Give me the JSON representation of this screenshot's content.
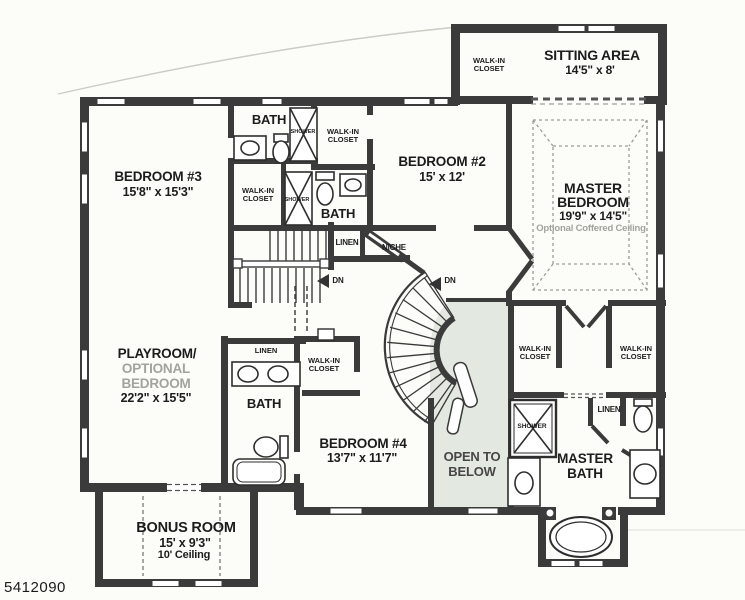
{
  "plan_number": "5412090",
  "colors": {
    "wall": "#3b3b3b",
    "open_below_fill": "#e3e8e0",
    "muted_text": "#a2a29e"
  },
  "rooms": {
    "bedroom3": {
      "name": "BEDROOM #3",
      "dims": "15'8\" x 15'3\""
    },
    "bedroom2": {
      "name": "BEDROOM #2",
      "dims": "15' x 12'"
    },
    "bedroom4": {
      "name": "BEDROOM #4",
      "dims": "13'7\" x 11'7\""
    },
    "sitting_area": {
      "name": "SITTING AREA",
      "dims": "14'5\" x 8'"
    },
    "master_bedroom": {
      "name1": "MASTER",
      "name2": "BEDROOM",
      "dims": "19'9\" x 14'5\"",
      "note": "Optional Coffered Ceiling"
    },
    "playroom": {
      "name1": "PLAYROOM/",
      "name2": "OPTIONAL",
      "name3": "BEDROOM",
      "dims": "22'2\" x 15'5\""
    },
    "bonus_room": {
      "name": "BONUS ROOM",
      "dims": "15' x 9'3\"",
      "note": "10' Ceiling"
    },
    "master_bath": {
      "name1": "MASTER",
      "name2": "BATH"
    },
    "open_to_below": {
      "line1": "OPEN TO",
      "line2": "BELOW"
    }
  },
  "labels": {
    "bath": "BATH",
    "shower": "SHOWER",
    "walk_in_line1": "WALK-IN",
    "walk_in_line2": "CLOSET",
    "linen": "LINEN",
    "niche": "NICHE",
    "down": "DN"
  }
}
